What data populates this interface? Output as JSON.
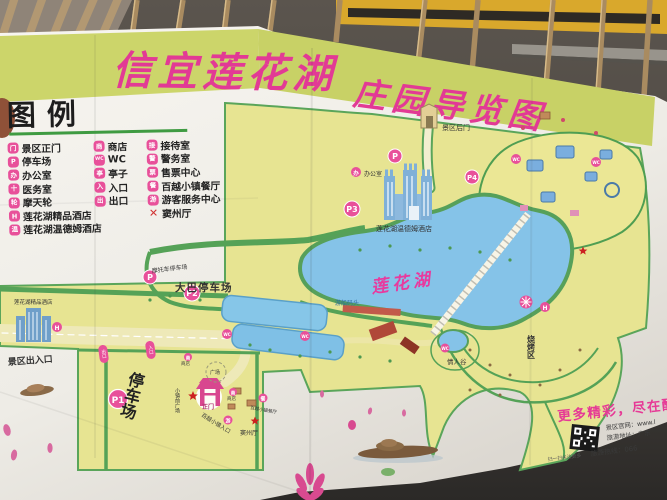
{
  "title": {
    "part1": "信宜莲花湖",
    "part2": "庄园导览图"
  },
  "legend": {
    "heading": "图例",
    "col1": [
      {
        "glyph": "门",
        "label": "景区正门"
      },
      {
        "glyph": "P",
        "label": "停车场"
      },
      {
        "glyph": "办",
        "label": "办公室"
      },
      {
        "glyph": "十",
        "label": "医务室"
      },
      {
        "glyph": "轮",
        "label": "摩天轮"
      },
      {
        "glyph": "H",
        "label": "莲花湖精品酒店"
      },
      {
        "glyph": "温",
        "label": "莲花湖温德姆酒店"
      }
    ],
    "col2": [
      {
        "glyph": "商",
        "label": "商店"
      },
      {
        "glyph": "WC",
        "label": "WC"
      },
      {
        "glyph": "亭",
        "label": "亭子"
      },
      {
        "glyph": "入",
        "label": "入口"
      },
      {
        "glyph": "出",
        "label": "出口"
      }
    ],
    "col3": [
      {
        "glyph": "接",
        "label": "接待室"
      },
      {
        "glyph": "警",
        "label": "警务室"
      },
      {
        "glyph": "票",
        "label": "售票中心"
      },
      {
        "glyph": "餐",
        "label": "百越小镇餐厅"
      },
      {
        "glyph": "游",
        "label": "游客服务中心"
      },
      {
        "glyph": "✕",
        "label": "窦州厅"
      }
    ]
  },
  "map": {
    "lake_name": "莲花湖",
    "labels": {
      "back_gate": "景区后门",
      "office": "办公室",
      "wyndham_hotel": "莲花湖温德姆酒店",
      "boutique_hotel": "莲花湖精品酒店",
      "motorcycle_parking": "摩托车停车场",
      "bus_parking": "大巴停车场",
      "parking_lot": "停车场",
      "scenic_entrance": "景区出入口",
      "boat_dock": "游船码头",
      "lovers_valley": "情人谷",
      "bbq_area": "烧烤区",
      "main_gate": "正门",
      "town_front_plaza": "小镇前广场",
      "town_entrance": "百越小镇入口",
      "douzhou_hall": "窦州厅",
      "town_restaurant": "百越小镇餐厅",
      "plaza": "广场",
      "shop": "商店"
    },
    "markers": {
      "p": "P",
      "p1": "P1",
      "p2": "P2",
      "p3": "P3",
      "p4": "P4",
      "wc": "WC",
      "hotel": "H",
      "office": "办",
      "restaurant": "餐",
      "visitor": "游",
      "shop": "商",
      "entrance": "入口",
      "exit": "出口"
    }
  },
  "footer": {
    "promo": "更多精彩，尽在醉",
    "website": "景区官网：www.l",
    "address": "旅游地址：广东",
    "hotline": "旅游热线：066",
    "qr_caption": "扫一扫关注更多"
  },
  "colors": {
    "title_pink": "#e23a95",
    "band_yellow": "#ccd56a",
    "land_yellow": "#e7e492",
    "lake_blue": "#85c3e8",
    "marker_pink": "#e8509a",
    "path_green": "#55a257",
    "paper": "#f2f0ea"
  }
}
